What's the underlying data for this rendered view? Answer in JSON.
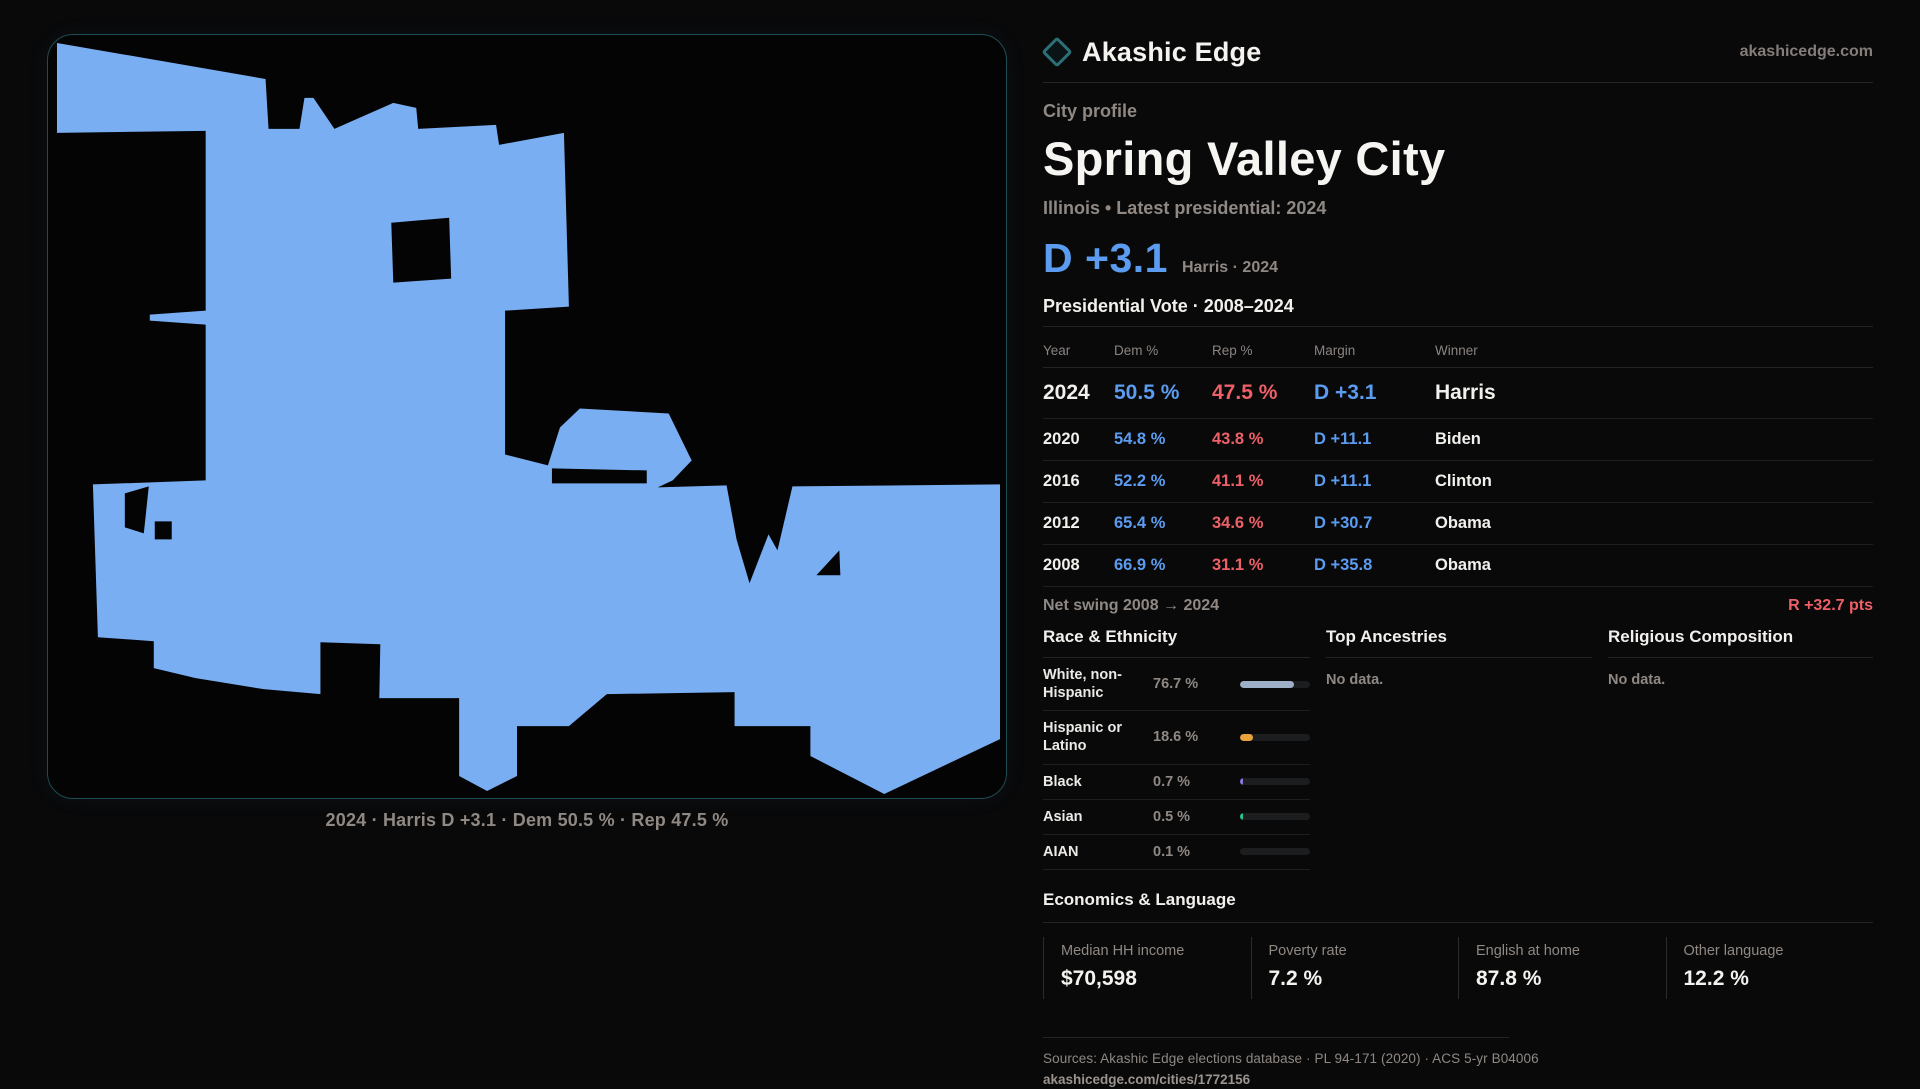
{
  "brand": {
    "name": "Akashic Edge",
    "domain": "akashicedge.com"
  },
  "profile": {
    "kicker": "City profile",
    "city": "Spring Valley City",
    "meta": "Illinois • Latest presidential: 2024",
    "headline_margin": "D +3.1",
    "headline_note": "Harris · 2024"
  },
  "map": {
    "caption": "2024 · Harris D +3.1 · Dem 50.5 % · Rep 47.5 %",
    "fill_color": "#79aef2"
  },
  "table": {
    "title": "Presidential Vote · 2008–2024",
    "headers": {
      "year": "Year",
      "dem": "Dem %",
      "rep": "Rep %",
      "margin": "Margin",
      "winner": "Winner"
    },
    "rows": [
      {
        "year": "2024",
        "dem": "50.5 %",
        "rep": "47.5 %",
        "margin": "D +3.1",
        "winner": "Harris"
      },
      {
        "year": "2020",
        "dem": "54.8 %",
        "rep": "43.8 %",
        "margin": "D +11.1",
        "winner": "Biden"
      },
      {
        "year": "2016",
        "dem": "52.2 %",
        "rep": "41.1 %",
        "margin": "D +11.1",
        "winner": "Clinton"
      },
      {
        "year": "2012",
        "dem": "65.4 %",
        "rep": "34.6 %",
        "margin": "D +30.7",
        "winner": "Obama"
      },
      {
        "year": "2008",
        "dem": "66.9 %",
        "rep": "31.1 %",
        "margin": "D +35.8",
        "winner": "Obama"
      }
    ],
    "net_swing_label": "Net swing 2008 → 2024",
    "net_swing_value": "R +32.7 pts"
  },
  "race": {
    "title": "Race & Ethnicity",
    "rows": [
      {
        "label": "White, non-Hispanic",
        "value": "76.7 %",
        "pct": 76.7,
        "color": "#9db0c8"
      },
      {
        "label": "Hispanic or Latino",
        "value": "18.6 %",
        "pct": 18.6,
        "color": "#e8a33c"
      },
      {
        "label": "Black",
        "value": "0.7 %",
        "pct": 0.7,
        "color": "#8678e0"
      },
      {
        "label": "Asian",
        "value": "0.5 %",
        "pct": 0.5,
        "color": "#2ec48f"
      },
      {
        "label": "AIAN",
        "value": "0.1 %",
        "pct": 0.1,
        "color": "#9db0c8"
      }
    ]
  },
  "ancestries": {
    "title": "Top Ancestries",
    "empty": "No data."
  },
  "religion": {
    "title": "Religious Composition",
    "empty": "No data."
  },
  "economics": {
    "title": "Economics & Language",
    "stats": [
      {
        "label": "Median HH income",
        "value": "$70,598"
      },
      {
        "label": "Poverty rate",
        "value": "7.2 %"
      },
      {
        "label": "English at home",
        "value": "87.8 %"
      },
      {
        "label": "Other language",
        "value": "12.2 %"
      }
    ]
  },
  "footer": {
    "sources": "Sources: Akashic Edge elections database · PL 94-171 (2020) · ACS 5-yr B04006",
    "permalink": "akashicedge.com/cities/1772156"
  }
}
